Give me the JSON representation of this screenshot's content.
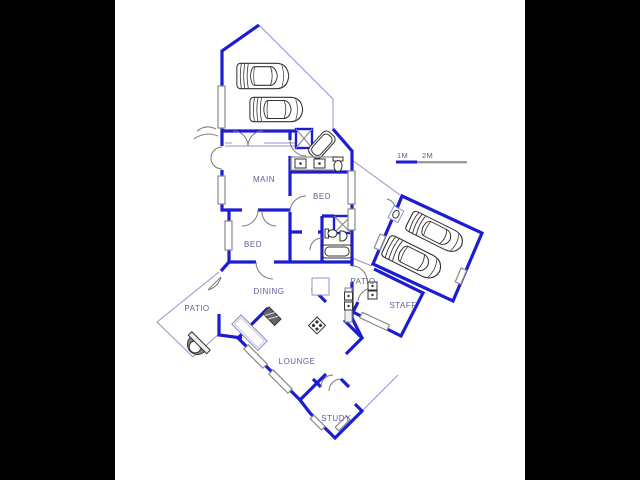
{
  "plan": {
    "rooms": {
      "main": "MAIN",
      "bed_right": "BED",
      "bed_left": "BED",
      "dining": "DINING",
      "patio_left": "PATIO",
      "patio_right": "PATIO",
      "lounge": "LOUNGE",
      "study": "STUDY",
      "staff": "STAFF"
    },
    "scale_bar": {
      "one": "1M",
      "two": "2M"
    },
    "colors": {
      "wall_blue": "#1c1cd2",
      "thin_blue": "#9393cc",
      "label_text": "#60609a",
      "detail_gray": "#8a8a8a",
      "fixture_dark": "#333333",
      "matte_black": "#000000",
      "paper_white": "#ffffff"
    },
    "icons": [
      "car-icon",
      "bathtub-icon",
      "shower-icon",
      "toilet-icon",
      "sink-icon",
      "stove-icon",
      "braai-icon",
      "fireplace-icon",
      "table-icon",
      "window-glyph",
      "door-arc"
    ]
  }
}
